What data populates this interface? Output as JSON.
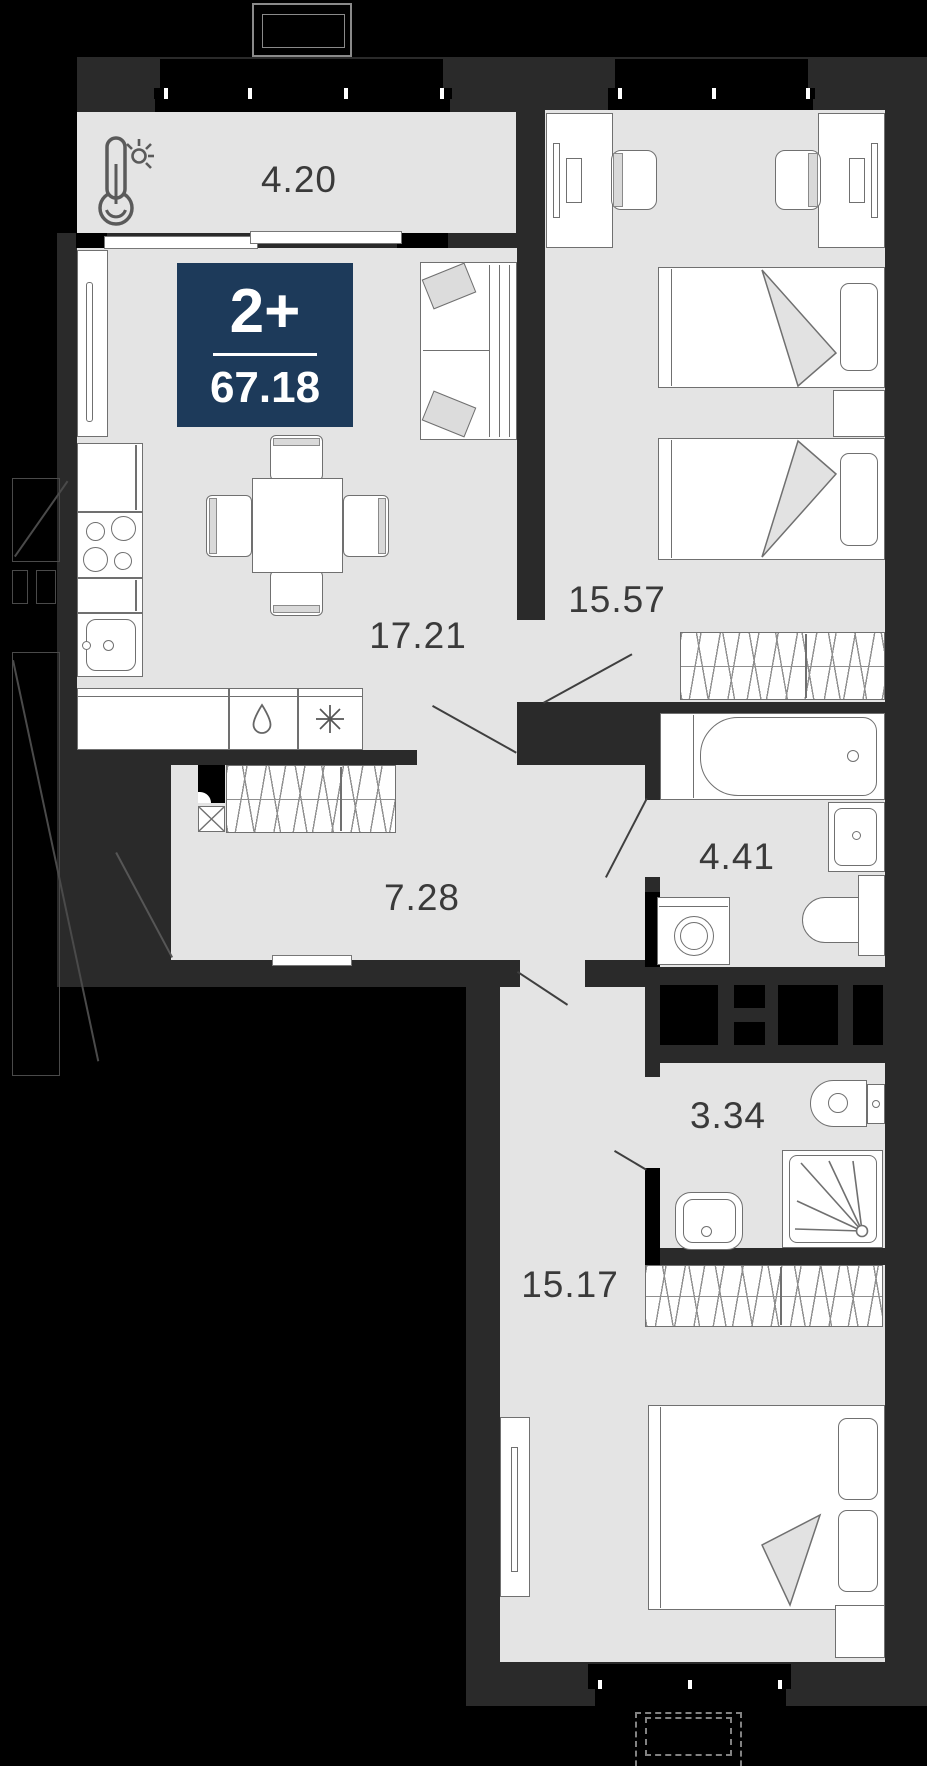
{
  "plan": {
    "badge": {
      "type_label": "2+",
      "area_total": "67.18"
    },
    "rooms": [
      {
        "id": "balcony",
        "area": "4.20"
      },
      {
        "id": "kitchen-living",
        "area": "17.21"
      },
      {
        "id": "bedroom-top",
        "area": "15.57"
      },
      {
        "id": "bathroom-large",
        "area": "4.41"
      },
      {
        "id": "hallway",
        "area": "7.28"
      },
      {
        "id": "bathroom-small",
        "area": "3.34"
      },
      {
        "id": "bedroom-bottom",
        "area": "15.17"
      }
    ],
    "icons": [
      "thermometer-sun-icon",
      "water-drop-icon",
      "snowflake-asterisk-icon",
      "shaft-cross-icon"
    ],
    "colors": {
      "background": "#000000",
      "wall": "#2a2a2a",
      "floor": "#e4e4e4",
      "furniture_outline": "#707070",
      "badge_bg": "#1d3a5a"
    }
  }
}
